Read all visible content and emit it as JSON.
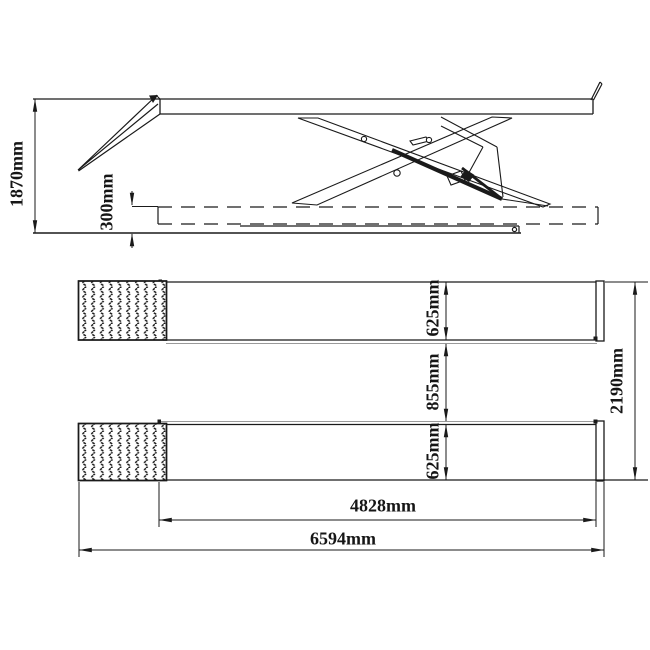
{
  "drawing": {
    "colors": {
      "background": "#ffffff",
      "line": "#1a1a1a",
      "secondary_line": "#9a9a9a"
    }
  },
  "dimensions": {
    "side_view": {
      "overall_height": "1870mm",
      "min_height": "300mm"
    },
    "plan_view": {
      "platform_width_upper": "625mm",
      "platform_gap": "855mm",
      "platform_width_lower": "625mm",
      "overall_width": "2190mm",
      "platform_length": "4828mm",
      "overall_length": "6594mm"
    }
  }
}
